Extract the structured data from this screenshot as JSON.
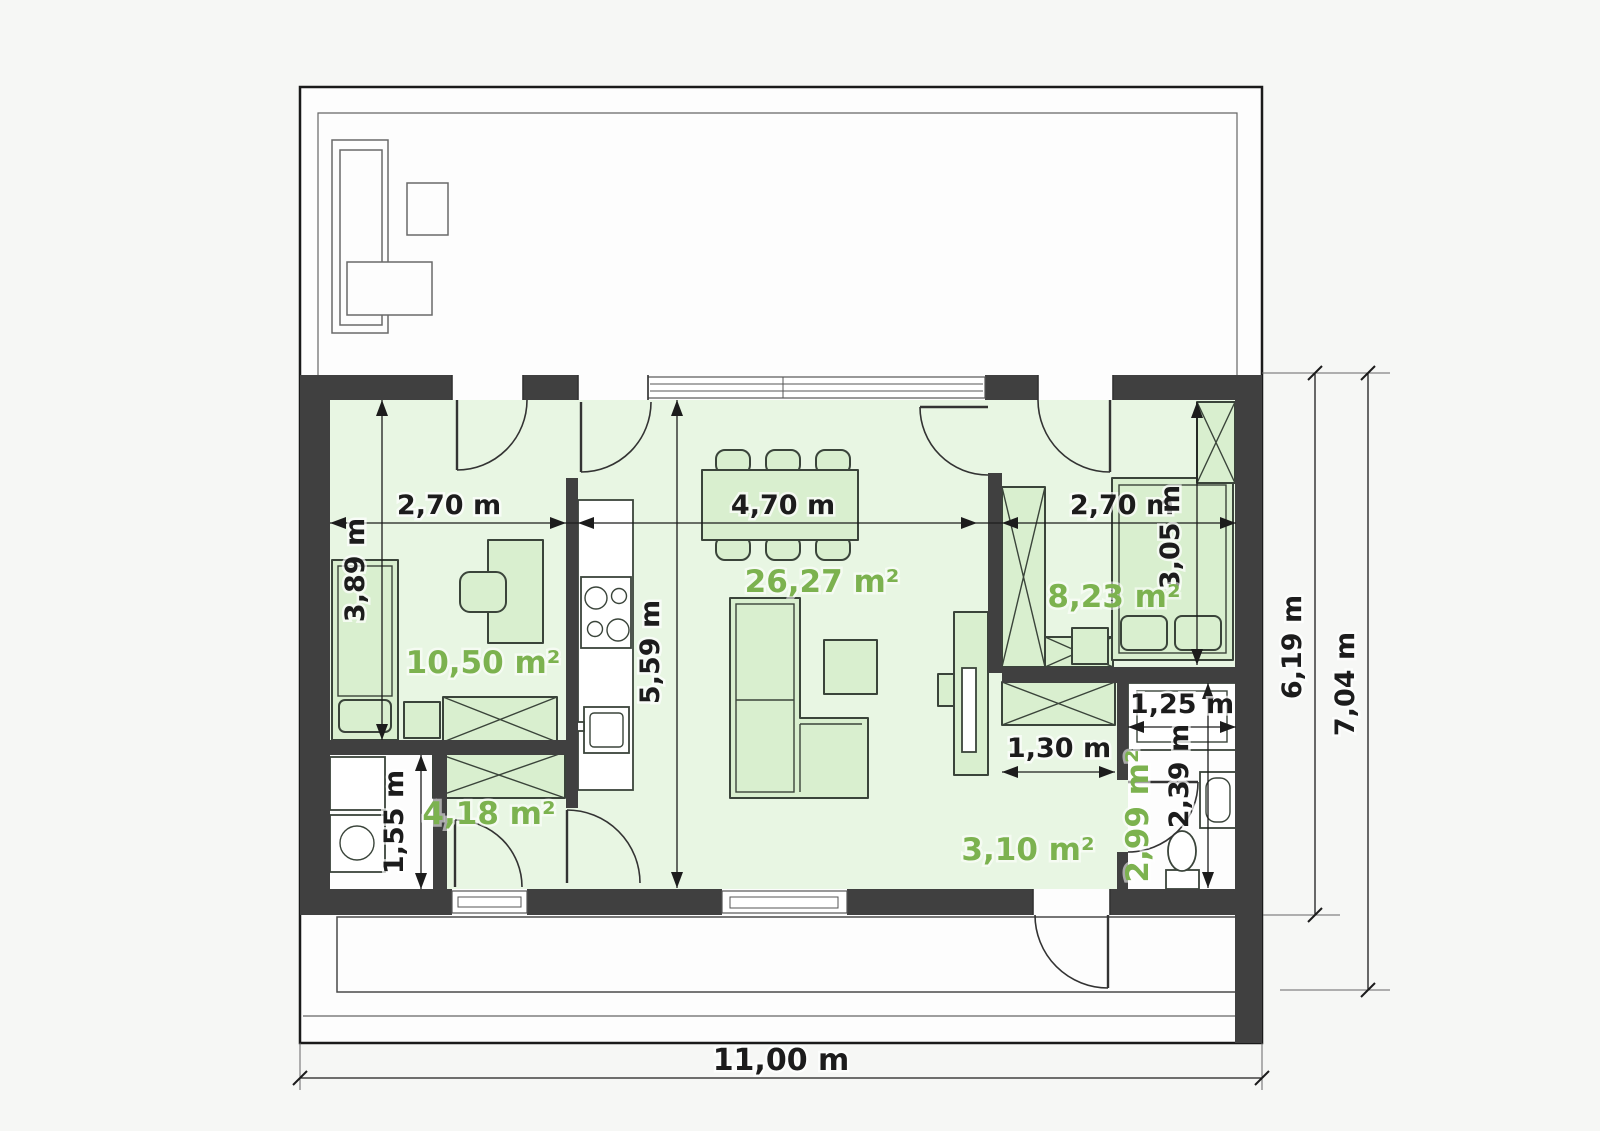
{
  "plan": {
    "site": {
      "total_width": "11,00 m",
      "house_depth": "6,19 m",
      "total_depth_with_porch": "7,04 m"
    },
    "rooms": {
      "room_left": {
        "area": "10,50 m²",
        "width": "2,70 m",
        "depth": "3,89 m"
      },
      "living": {
        "area": "26,27 m²",
        "width": "4,70 m",
        "depth": "5,59 m"
      },
      "bedroom": {
        "area": "8,23 m²",
        "width": "2,70 m",
        "depth": "3,05 m"
      },
      "hall": {
        "area": "4,18 m²"
      },
      "utility": {
        "depth": "1,55 m"
      },
      "entry": {
        "area": "3,10 m²",
        "wardrobe_width": "1,30 m"
      },
      "bathroom": {
        "area": "2,99 m²",
        "width": "1,25 m",
        "depth": "2,39 m"
      }
    },
    "colors": {
      "wall": "#404040",
      "room_fill": "#e8f6e3",
      "furniture_fill": "#d9efcf",
      "area_label_green": "#7cb24f",
      "dimension_text": "#1c1c1c"
    }
  }
}
